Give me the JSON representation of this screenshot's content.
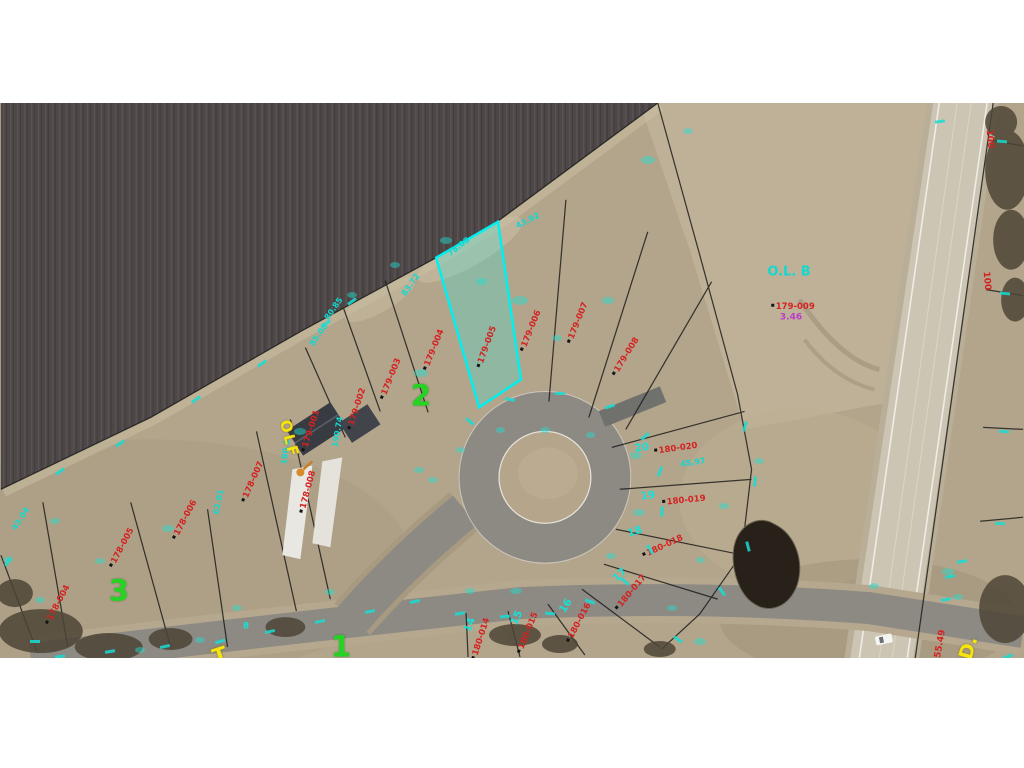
{
  "colors": {
    "cyan": "#12d8d0",
    "red": "#d42222",
    "green": "#25d422",
    "yellow": "#f6e40a",
    "magenta": "#b93ccb",
    "highlight": "#00f0f0",
    "field": "#4e4747",
    "asphalt": "#8d8a84",
    "highway": "#cdc5b4",
    "terrain": "#b3a58b"
  },
  "map": {
    "labels": [
      {
        "t": "179-001",
        "x": 311,
        "y": 431,
        "r": -72,
        "c": "red",
        "dot": true
      },
      {
        "t": "179-002",
        "x": 357,
        "y": 409,
        "r": -72,
        "c": "red",
        "dot": true
      },
      {
        "t": "179-003",
        "x": 391,
        "y": 379,
        "r": -68,
        "c": "red",
        "dot": true
      },
      {
        "t": "179-004",
        "x": 434,
        "y": 350,
        "r": -68,
        "c": "red",
        "dot": true
      },
      {
        "t": "179-005",
        "x": 487,
        "y": 347,
        "r": -70,
        "c": "red",
        "dot": true
      },
      {
        "t": "179-006",
        "x": 531,
        "y": 331,
        "r": -68,
        "c": "red",
        "dot": true
      },
      {
        "t": "179-007",
        "x": 578,
        "y": 323,
        "r": -68,
        "c": "red",
        "dot": true
      },
      {
        "t": "179-008",
        "x": 626,
        "y": 357,
        "r": -58,
        "c": "red",
        "dot": true
      },
      {
        "t": "179-009",
        "x": 793,
        "y": 307,
        "r": 0,
        "c": "red",
        "dot": true
      },
      {
        "t": "3.46",
        "x": 791,
        "y": 318,
        "r": 0,
        "c": "magenta"
      },
      {
        "t": "178-008",
        "x": 308,
        "y": 492,
        "r": -75,
        "c": "red",
        "dot": true
      },
      {
        "t": "178-007",
        "x": 253,
        "y": 482,
        "r": -66,
        "c": "red",
        "dot": true
      },
      {
        "t": "178-006",
        "x": 185,
        "y": 520,
        "r": -62,
        "c": "red",
        "dot": true
      },
      {
        "t": "178-005",
        "x": 122,
        "y": 548,
        "r": -62,
        "c": "red",
        "dot": true
      },
      {
        "t": "178-004",
        "x": 58,
        "y": 605,
        "r": -62,
        "c": "red",
        "dot": true
      },
      {
        "t": "180-020",
        "x": 676,
        "y": 449,
        "r": -8,
        "c": "red",
        "dot": true
      },
      {
        "t": "180-019",
        "x": 684,
        "y": 501,
        "r": -6,
        "c": "red",
        "dot": true
      },
      {
        "t": "180-018",
        "x": 663,
        "y": 547,
        "r": -25,
        "c": "red",
        "dot": true
      },
      {
        "t": "180-017",
        "x": 631,
        "y": 593,
        "r": -50,
        "c": "red",
        "dot": true
      },
      {
        "t": "180-016",
        "x": 579,
        "y": 623,
        "r": -62,
        "c": "red",
        "dot": true
      },
      {
        "t": "180-015",
        "x": 528,
        "y": 633,
        "r": -68,
        "c": "red",
        "dot": true
      },
      {
        "t": "180-014",
        "x": 481,
        "y": 639,
        "r": -72,
        "c": "red",
        "dot": true
      },
      {
        "t": "100",
        "x": 989,
        "y": 139,
        "r": 85,
        "c": "red",
        "s": 9
      },
      {
        "t": "100",
        "x": 986,
        "y": 281,
        "r": 85,
        "c": "red",
        "s": 9
      },
      {
        "t": "55.49",
        "x": 941,
        "y": 644,
        "r": -80,
        "c": "red",
        "s": 9
      },
      {
        "t": "O.L. B",
        "x": 789,
        "y": 272,
        "r": 0,
        "c": "cyan",
        "s": 13
      },
      {
        "t": "43.92",
        "x": 528,
        "y": 221,
        "r": -27,
        "c": "cyan"
      },
      {
        "t": "78.08",
        "x": 459,
        "y": 247,
        "r": -38,
        "c": "cyan"
      },
      {
        "t": "83.72",
        "x": 411,
        "y": 285,
        "r": -55,
        "c": "cyan"
      },
      {
        "t": "80.85",
        "x": 334,
        "y": 309,
        "r": -55,
        "c": "cyan"
      },
      {
        "t": "85.08",
        "x": 319,
        "y": 335,
        "r": -55,
        "c": "cyan"
      },
      {
        "t": "190.74",
        "x": 338,
        "y": 432,
        "r": -80,
        "c": "cyan"
      },
      {
        "t": "180.1",
        "x": 286,
        "y": 452,
        "r": -82,
        "c": "cyan"
      },
      {
        "t": "62.01",
        "x": 219,
        "y": 502,
        "r": -78,
        "c": "cyan"
      },
      {
        "t": "43.04",
        "x": 21,
        "y": 519,
        "r": -58,
        "c": "cyan"
      },
      {
        "t": "45.97",
        "x": 693,
        "y": 463,
        "r": -8,
        "c": "cyan"
      },
      {
        "t": "20",
        "x": 642,
        "y": 448,
        "r": -8,
        "c": "lot"
      },
      {
        "t": "19",
        "x": 648,
        "y": 496,
        "r": -6,
        "c": "lot"
      },
      {
        "t": "18",
        "x": 635,
        "y": 532,
        "r": -18,
        "c": "lot"
      },
      {
        "t": "17",
        "x": 620,
        "y": 575,
        "r": -45,
        "c": "lot"
      },
      {
        "t": "16",
        "x": 566,
        "y": 606,
        "r": -58,
        "c": "lot"
      },
      {
        "t": "15",
        "x": 517,
        "y": 618,
        "r": -65,
        "c": "lot"
      },
      {
        "t": "14",
        "x": 470,
        "y": 625,
        "r": -70,
        "c": "lot"
      },
      {
        "t": "8",
        "x": 246,
        "y": 627,
        "r": 0,
        "c": "lot",
        "s": 9
      },
      {
        "t": "2",
        "x": 421,
        "y": 396,
        "r": 0,
        "c": "green"
      },
      {
        "t": "3",
        "x": 119,
        "y": 591,
        "r": 0,
        "c": "green"
      },
      {
        "t": "1",
        "x": 341,
        "y": 647,
        "r": 0,
        "c": "green"
      },
      {
        "t": "OLF",
        "x": 289,
        "y": 439,
        "r": 76,
        "c": "yellow",
        "s": 15,
        "ls": 2
      },
      {
        "t": "T",
        "x": 220,
        "y": 656,
        "r": -18,
        "c": "yellow",
        "s": 21
      },
      {
        "t": "D.",
        "x": 969,
        "y": 648,
        "r": -74,
        "c": "yellow",
        "s": 19
      }
    ],
    "ticks": [
      [
        352,
        300,
        -35
      ],
      [
        326,
        322,
        -35
      ],
      [
        262,
        362,
        -35
      ],
      [
        196,
        398,
        -35
      ],
      [
        120,
        442,
        -35
      ],
      [
        60,
        470,
        -35
      ],
      [
        470,
        420,
        40
      ],
      [
        510,
        398,
        10
      ],
      [
        560,
        392,
        0
      ],
      [
        610,
        405,
        -20
      ],
      [
        645,
        435,
        -40
      ],
      [
        660,
        470,
        -70
      ],
      [
        662,
        510,
        -85
      ],
      [
        650,
        548,
        60
      ],
      [
        625,
        580,
        40
      ],
      [
        590,
        600,
        20
      ],
      [
        550,
        612,
        5
      ],
      [
        505,
        615,
        -5
      ],
      [
        460,
        612,
        -10
      ],
      [
        415,
        600,
        -12
      ],
      [
        370,
        610,
        -12
      ],
      [
        320,
        620,
        -12
      ],
      [
        270,
        630,
        -12
      ],
      [
        220,
        640,
        -15
      ],
      [
        165,
        645,
        -12
      ],
      [
        110,
        650,
        -10
      ],
      [
        60,
        655,
        -8
      ],
      [
        8,
        560,
        -60
      ],
      [
        35,
        640,
        0
      ],
      [
        745,
        425,
        -75
      ],
      [
        755,
        480,
        -85
      ],
      [
        748,
        545,
        75
      ],
      [
        722,
        590,
        55
      ],
      [
        678,
        638,
        35
      ],
      [
        950,
        575,
        -10
      ],
      [
        962,
        560,
        -10
      ],
      [
        946,
        598,
        -10
      ],
      [
        1008,
        655,
        -20
      ],
      [
        1002,
        140,
        5
      ],
      [
        1005,
        292,
        5
      ],
      [
        1004,
        430,
        5
      ],
      [
        1000,
        522,
        5
      ],
      [
        940,
        120,
        -8
      ]
    ],
    "patches": [
      [
        520,
        300,
        16,
        9
      ],
      [
        481,
        281,
        11,
        7
      ],
      [
        421,
        373,
        14,
        8
      ],
      [
        300,
        431,
        12,
        7
      ],
      [
        557,
        338,
        10,
        6
      ],
      [
        608,
        300,
        12,
        7
      ],
      [
        648,
        160,
        14,
        8
      ],
      [
        688,
        131,
        10,
        6
      ],
      [
        636,
        455,
        12,
        7
      ],
      [
        639,
        512,
        12,
        7
      ],
      [
        611,
        556,
        10,
        6
      ],
      [
        516,
        591,
        12,
        6
      ],
      [
        470,
        591,
        10,
        6
      ],
      [
        419,
        470,
        10,
        6
      ],
      [
        168,
        528,
        12,
        7
      ],
      [
        100,
        561,
        10,
        6
      ],
      [
        55,
        521,
        10,
        6
      ],
      [
        237,
        608,
        10,
        6
      ],
      [
        330,
        592,
        10,
        6
      ],
      [
        700,
        641,
        12,
        7
      ],
      [
        759,
        461,
        10,
        6
      ],
      [
        724,
        506,
        10,
        6
      ],
      [
        874,
        586,
        10,
        6
      ],
      [
        948,
        571,
        12,
        7
      ],
      [
        958,
        597,
        10,
        6
      ],
      [
        446,
        240,
        12,
        7
      ],
      [
        395,
        265,
        10,
        6
      ],
      [
        352,
        295,
        10,
        6
      ],
      [
        545,
        430,
        10,
        6
      ],
      [
        500,
        430,
        9,
        6
      ],
      [
        590,
        435,
        9,
        6
      ],
      [
        460,
        450,
        9,
        6
      ],
      [
        432,
        480,
        9,
        6
      ],
      [
        672,
        608,
        10,
        6
      ],
      [
        700,
        560,
        9,
        6
      ],
      [
        200,
        640,
        10,
        6
      ],
      [
        140,
        650,
        10,
        6
      ],
      [
        40,
        600,
        10,
        6
      ],
      [
        8,
        560,
        10,
        6
      ]
    ]
  }
}
